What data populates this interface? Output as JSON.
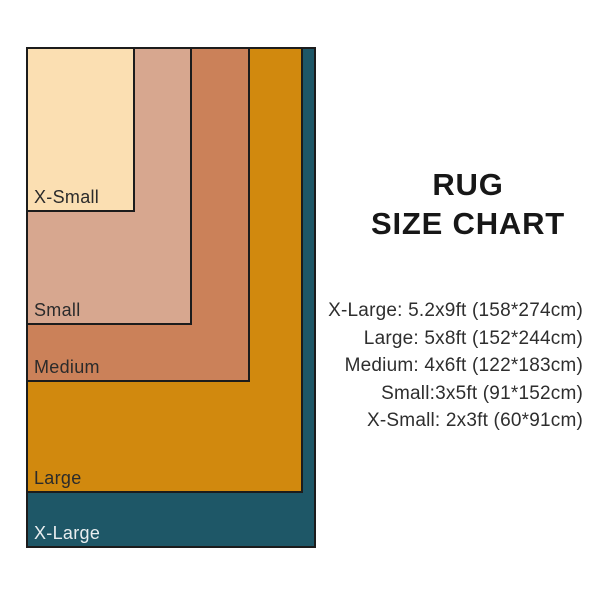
{
  "title": {
    "line1": "RUG",
    "line2": "SIZE CHART"
  },
  "diagram": {
    "rugs": [
      {
        "label": "X-Small",
        "feet": "2x3ft",
        "cm": "60*91cm",
        "fill": "#fbdfb2",
        "label_color": "#2b2b2b",
        "width_px": 109,
        "height_px": 165
      },
      {
        "label": "Small",
        "feet": "3x5ft",
        "cm": "91*152cm",
        "fill": "#d7a78f",
        "label_color": "#2b2b2b",
        "width_px": 166,
        "height_px": 278
      },
      {
        "label": "Medium",
        "feet": "4x6ft",
        "cm": "122*183cm",
        "fill": "#cb8159",
        "label_color": "#2b2b2b",
        "width_px": 224,
        "height_px": 335
      },
      {
        "label": "Large",
        "feet": "5x8ft",
        "cm": "152*244cm",
        "fill": "#d1890e",
        "label_color": "#2b2b2b",
        "width_px": 277,
        "height_px": 446
      },
      {
        "label": "X-Large",
        "feet": "5.2x9ft",
        "cm": "158*274cm",
        "fill": "#1e5767",
        "label_color": "#e9eef0",
        "width_px": 290,
        "height_px": 501
      }
    ],
    "border_color": "#1c1c1c"
  },
  "specs": [
    "X-Large: 5.2x9ft (158*274cm)",
    "Large: 5x8ft (152*244cm)",
    "Medium: 4x6ft (122*183cm)",
    "Small:3x5ft (91*152cm)",
    "X-Small: 2x3ft (60*91cm)"
  ]
}
